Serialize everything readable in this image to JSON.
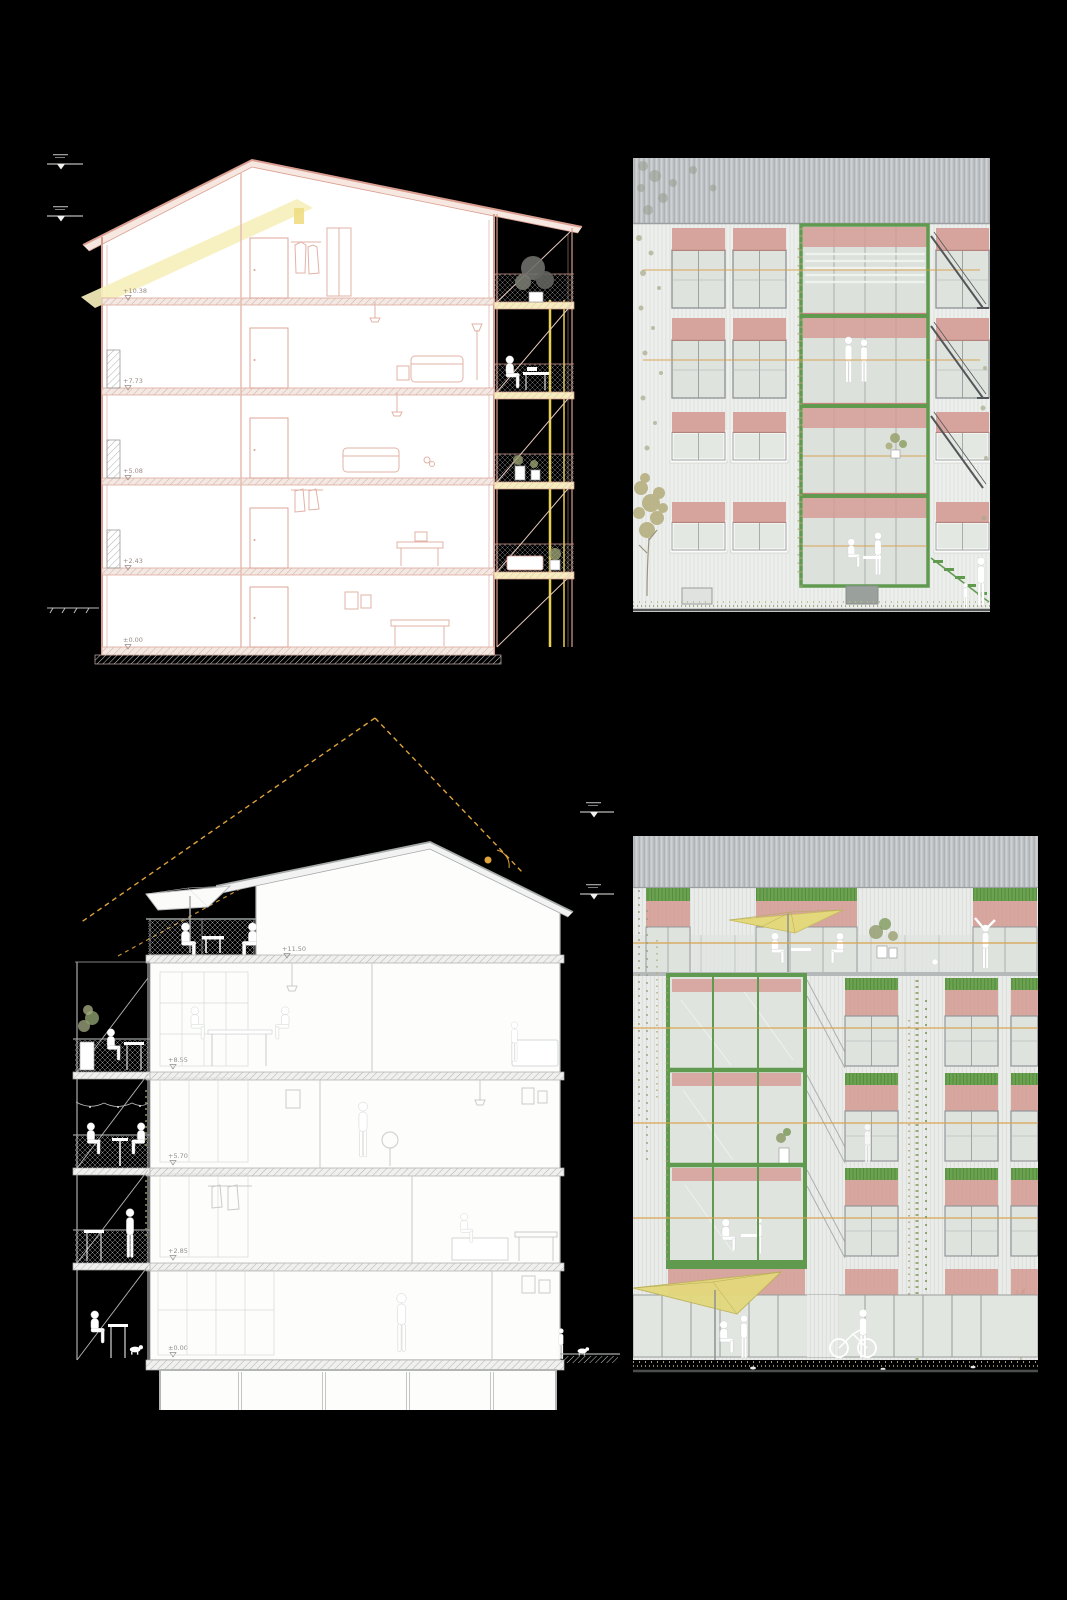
{
  "sheet": {
    "background_color": "#000000",
    "description": "Architecture sheet: two building cross-sections and two facade elevations"
  },
  "palette": {
    "section_pink_line": "#d99e8f",
    "section_gray_line": "#9aa09f",
    "sunbeam_yellow": "#f6f0bc",
    "balcony_post_yellow": "#e8d052",
    "sun_path_orange": "#dda23c",
    "railing_orange": "#d8a24e",
    "awning_pink": "#d49a92",
    "frame_green": "#5f9a4e",
    "header_green": "#6ba24f",
    "umbrella_yellow": "#e3d87c",
    "corrugated_gray": "#c4c7ca",
    "facade_wall": "#edefec",
    "glass_gray_green": "#dfe3de",
    "vegetation_olive": "#a8a36b",
    "figure_white": "#ffffff"
  },
  "panels": {
    "section_upper": {
      "name": "building-cross-section-upper",
      "levels": [
        {
          "label": "+10.38"
        },
        {
          "label": "+7.73"
        },
        {
          "label": "+5.08"
        },
        {
          "label": "+2.43"
        },
        {
          "label": "±0.00"
        }
      ]
    },
    "elevation_upper": {
      "name": "facade-elevation-upper"
    },
    "section_lower": {
      "name": "building-cross-section-lower",
      "levels": [
        {
          "label": "+11.50"
        },
        {
          "label": "+8.55"
        },
        {
          "label": "+5.70"
        },
        {
          "label": "+2.85"
        },
        {
          "label": "±0.00"
        }
      ]
    },
    "elevation_lower": {
      "name": "facade-elevation-lower"
    }
  }
}
